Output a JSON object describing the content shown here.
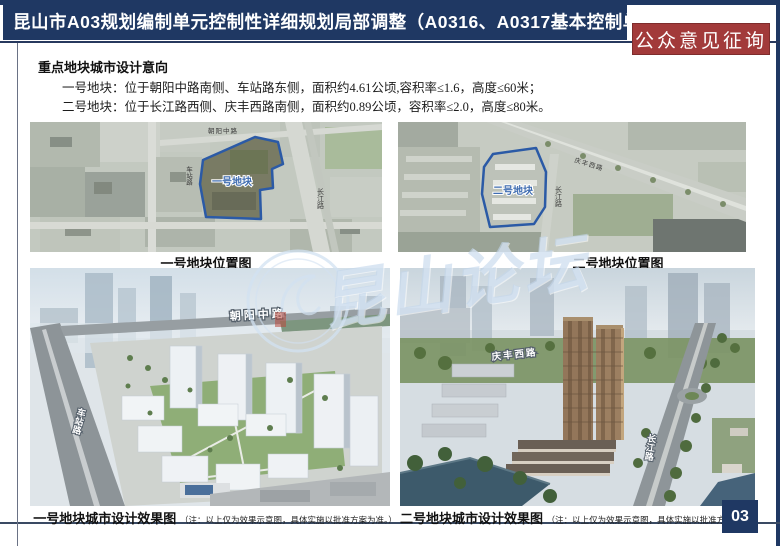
{
  "header": {
    "title": "昆山市A03规划编制单元控制性详细规划局部调整（A0316、A0317基本控制单元）",
    "notice_badge": "公众意见征询"
  },
  "section": {
    "heading": "重点地块城市设计意向",
    "line1": "一号地块：位于朝阳中路南侧、车站路东侧，面积约4.61公顷,容积率≤1.6，高度≤60米；",
    "line2": "二号地块：位于长江路西侧、庆丰西路南侧，面积约0.89公顷，容积率≤2.0，高度≤80米。"
  },
  "maps": {
    "plot1": {
      "caption": "一号地块位置图",
      "plot_label": "一号地块",
      "roads": [
        "朝阳中路",
        "车站路",
        "长江路"
      ]
    },
    "plot2": {
      "caption": "二号地块位置图",
      "plot_label": "二号地块",
      "roads": [
        "庆丰西路",
        "长江路"
      ]
    }
  },
  "renderings": {
    "plot1": {
      "caption": "一号地块城市设计效果图",
      "caption_note": "（注：以上仅为效果示意图，具体实施以批准方案为准。）",
      "roads": [
        "朝阳中路",
        "车站路"
      ]
    },
    "plot2": {
      "caption": "二号地块城市设计效果图",
      "caption_note": "（注：以上仅为效果示意图，具体实施以批准方案为准。）",
      "roads": [
        "庆丰西路",
        "长江路"
      ]
    }
  },
  "watermark": {
    "text": "昆山论坛"
  },
  "footer": {
    "page_number": "03"
  },
  "colors": {
    "navy": "#1f3863",
    "badge_red": "#a23a3a",
    "plot_outline_blue": "#2b5aa6"
  }
}
